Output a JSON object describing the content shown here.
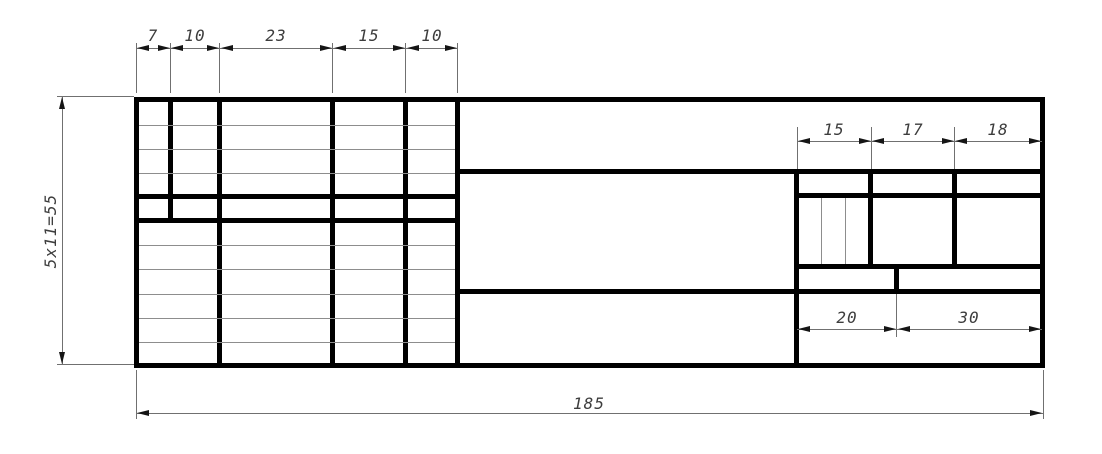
{
  "drawing": {
    "kind": "engineering-title-block-template",
    "colors": {
      "thick_line": "#000000",
      "thin_line": "#8d8d8d",
      "dimension_line": "#707070",
      "dimension_text": "#3d3d3d",
      "background": "#ffffff"
    },
    "dims": {
      "top_columns": [
        "7",
        "10",
        "23",
        "15",
        "10"
      ],
      "left_height": "5x11=55",
      "right_header_columns": [
        "15",
        "17",
        "18"
      ],
      "right_footer_columns": [
        "20",
        "30"
      ],
      "total_width": "185"
    }
  }
}
